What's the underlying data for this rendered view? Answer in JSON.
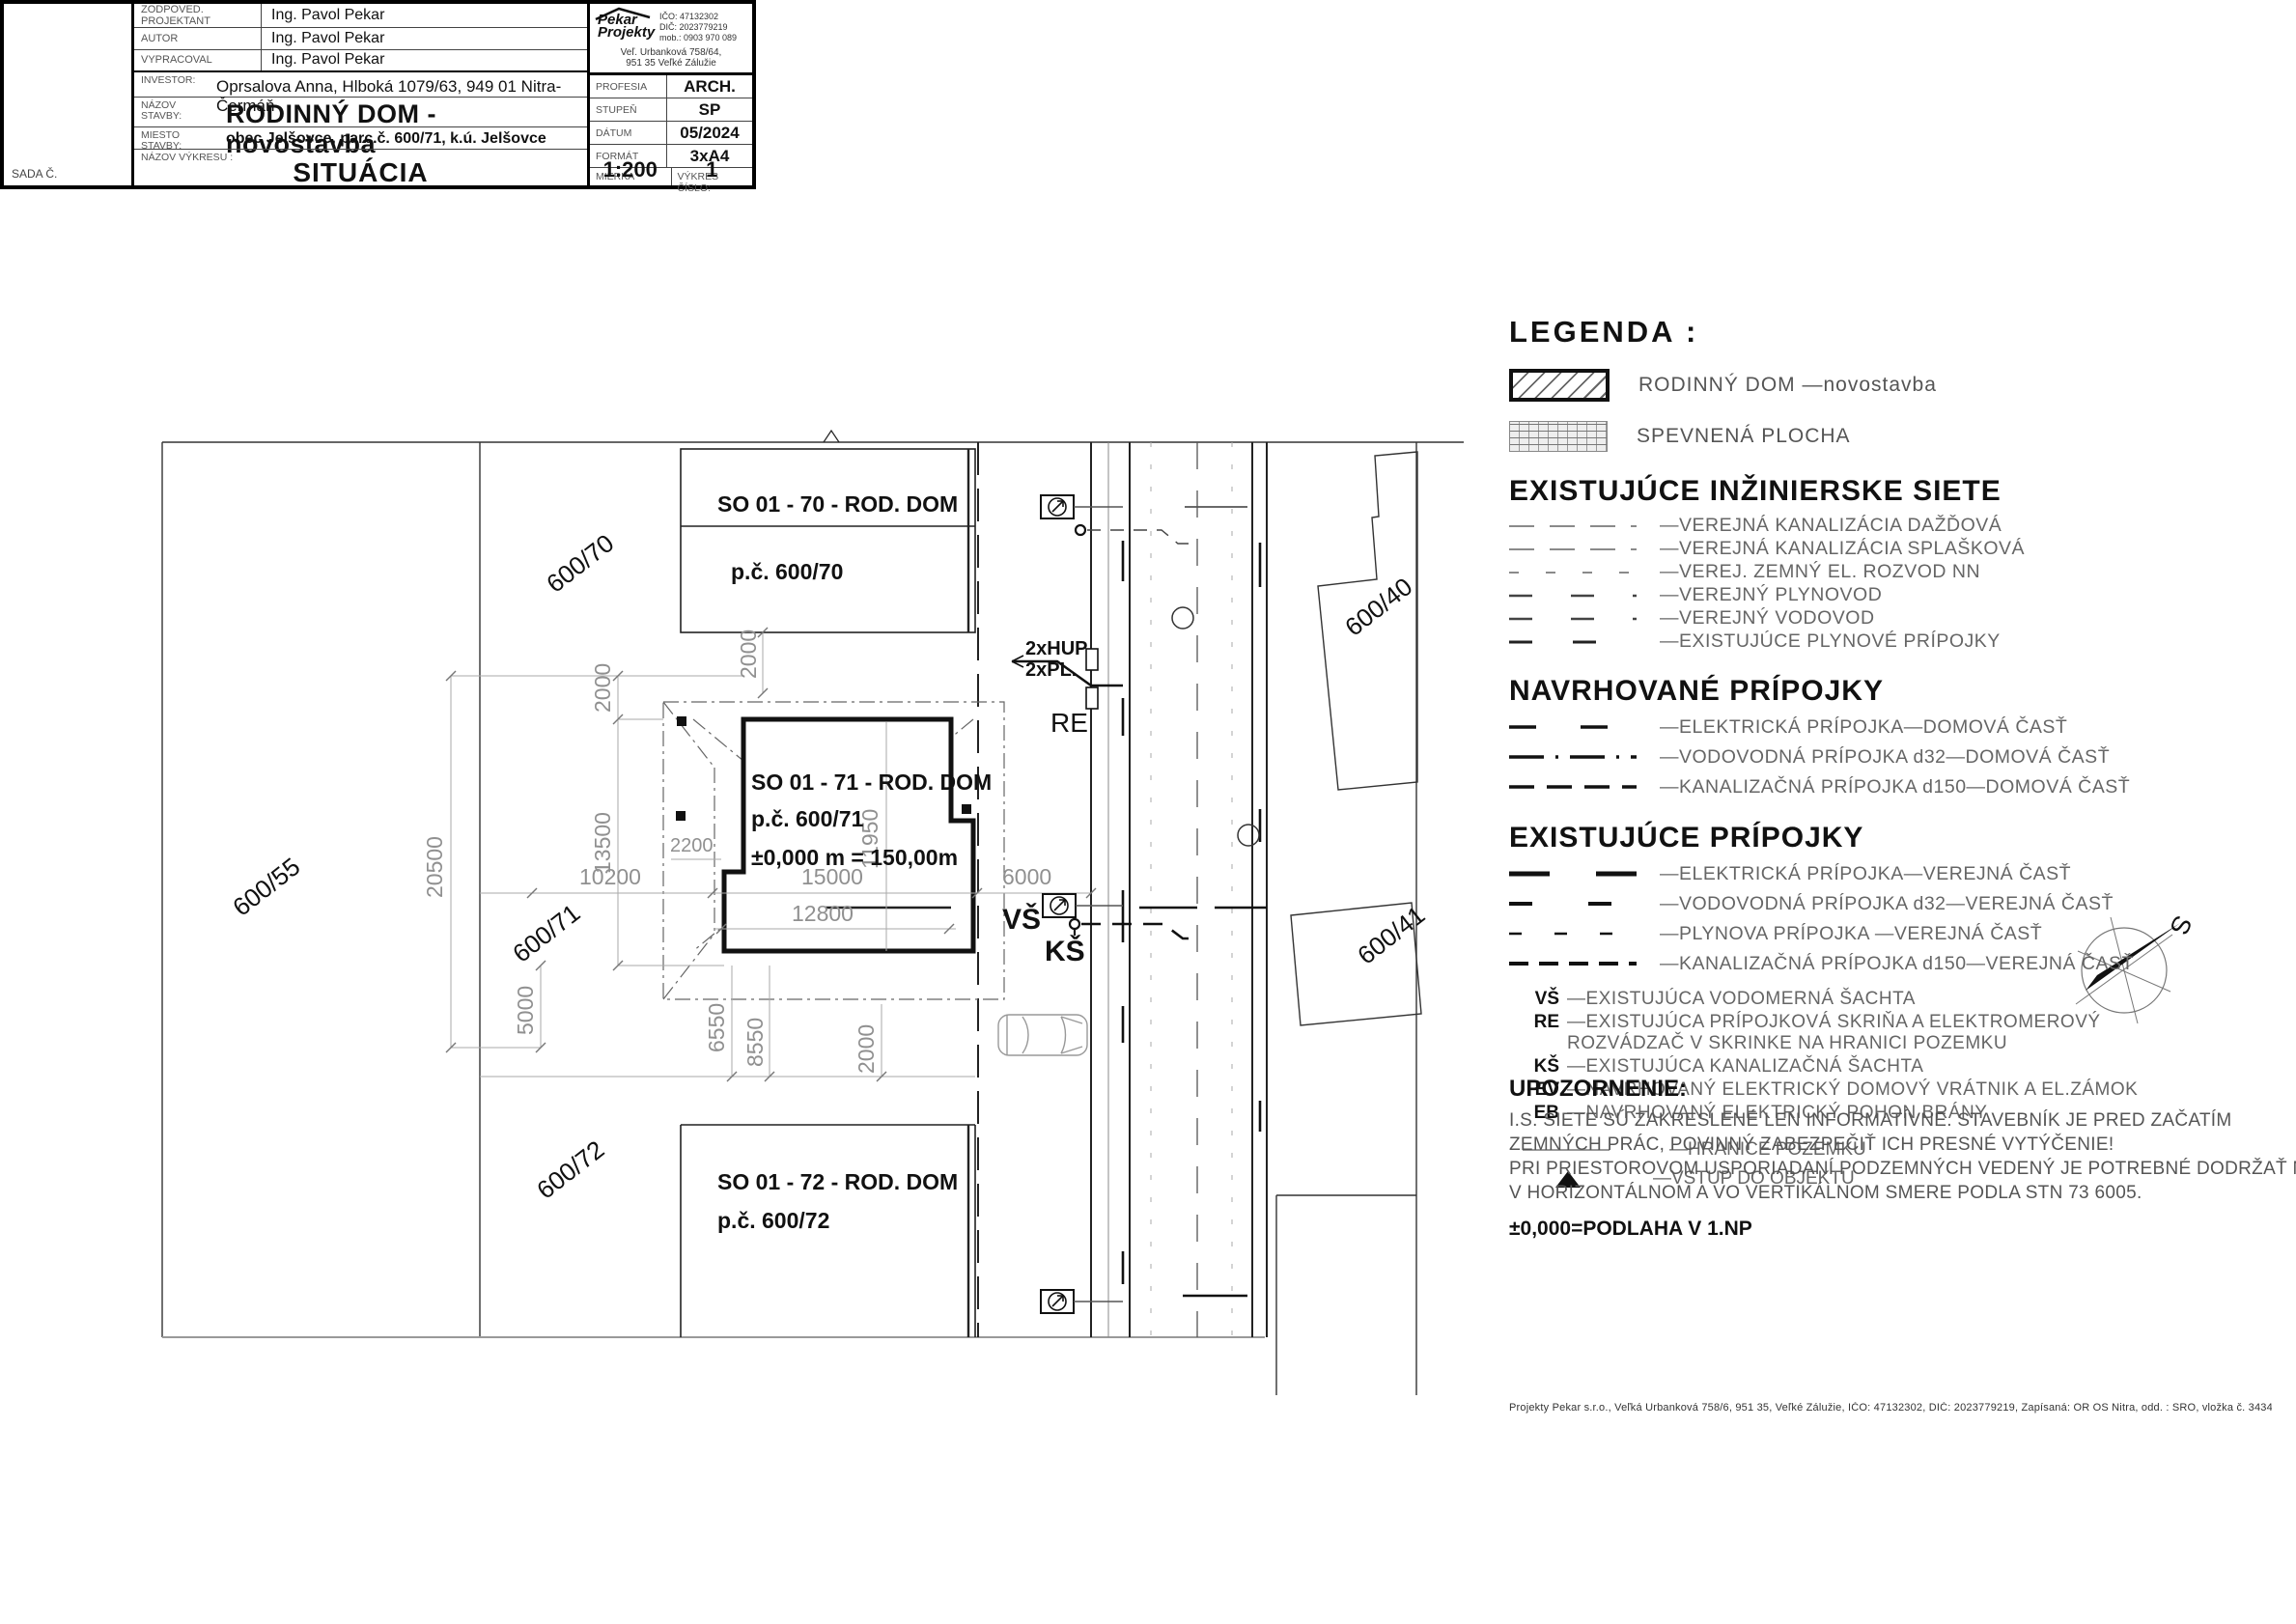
{
  "legend": {
    "title": "LEGENDA :",
    "swatches": [
      {
        "label": "RODINNÝ DOM  —novostavba"
      },
      {
        "label": "SPEVNENÁ PLOCHA"
      }
    ],
    "sections": [
      {
        "heading": "EXISTUJÚCE INŽINIERSKE SIETE",
        "items": [
          "—VEREJNÁ KANALIZÁCIA DAŽĎOVÁ",
          "—VEREJNÁ KANALIZÁCIA SPLAŠKOVÁ",
          "—VEREJ. ZEMNÝ EL. ROZVOD NN",
          "—VEREJNÝ PLYNOVOD",
          "—VEREJNÝ VODOVOD",
          "—EXISTUJÚCE PLYNOVÉ PRÍPOJKY"
        ]
      },
      {
        "heading": "NAVRHOVANÉ PRÍPOJKY",
        "items": [
          "—ELEKTRICKÁ PRÍPOJKA—DOMOVÁ ČASŤ",
          "—VODOVODNÁ PRÍPOJKA d32—DOMOVÁ ČASŤ",
          "—KANALIZAČNÁ PRÍPOJKA d150—DOMOVÁ ČASŤ"
        ]
      },
      {
        "heading": "EXISTUJÚCE PRÍPOJKY",
        "items": [
          "—ELEKTRICKÁ PRÍPOJKA—VEREJNÁ ČASŤ",
          "—VODOVODNÁ PRÍPOJKA d32—VEREJNÁ ČASŤ",
          "—PLYNOVA PRÍPOJKA —VEREJNÁ ČASŤ",
          "—KANALIZAČNÁ PRÍPOJKA d150—VEREJNÁ ČASŤ"
        ]
      }
    ],
    "abbreviations": [
      {
        "abbr": "VŠ",
        "text": "—EXISTUJÚCA VODOMERNÁ ŠACHTA"
      },
      {
        "abbr": "RE",
        "text": "—EXISTUJÚCA PRÍPOJKOVÁ SKRIŇA A ELEKTROMEROVÝ",
        "text2": "ROZVÁDZAČ V SKRINKE NA HRANICI POZEMKU"
      },
      {
        "abbr": "KŠ",
        "text": "—EXISTUJÚCA KANALIZAČNÁ ŠACHTA"
      },
      {
        "abbr": "EV",
        "text": "—NAVRHOVANÝ ELEKTRICKÝ DOMOVÝ VRÁTNIK A EL.ZÁMOK"
      },
      {
        "abbr": "EB",
        "text": "—NAVRHOVANÝ ELEKTRICKÝ POHON BRÁNY"
      }
    ],
    "boundary_label": "—HRANICE POZEMKU",
    "entrance_label": "—VSTUP DO OBJEKTU"
  },
  "notice": {
    "title": "UPOZORNENIE:",
    "lines": [
      "I.S. SIETE SÚ ZAKRESLENÉ LEN INFORMATÍVNE. STAVEBNÍK JE PRED ZAČATÍM",
      "ZEMNÝCH PRÁC, POVINNÝ ZABEZPEČIŤ ICH PRESNÉ VYTÝČENIE!",
      "PRI PRIESTOROVOM USPORIADANÍ PODZEMNÝCH VEDENÝ JE POTREBNÉ DODRŽAŤ MIN. VZDIALENOSTI",
      "V HORIZONTÁLNOM A VO VERTIKÁLNOM SMERE PODLA STN 73 6005."
    ],
    "level_note": "±0,000=PODLAHA V 1.NP"
  },
  "titleblock": {
    "rows": [
      {
        "label": "ZODPOVED. PROJEKTANT",
        "value": "Ing. Pavol Pekar"
      },
      {
        "label": "AUTOR",
        "value": "Ing. Pavol Pekar"
      },
      {
        "label": "VYPRACOVAL",
        "value": "Ing. Pavol Pekar"
      }
    ],
    "investor_label": "INVESTOR:",
    "investor": "Oprsalova Anna, Hlboká 1079/63, 949 01 Nitra-Čermáň",
    "nazov_label1": "NÁZOV",
    "nazov_label2": "STAVBY:",
    "nazov_stavby": "RODINNÝ DOM - novostavba",
    "miesto_label1": "MIESTO",
    "miesto_label2": "STAVBY:",
    "miesto_stavby": "obec Jelšovce, parc.č. 600/71, k.ú. Jelšovce",
    "vykres_label": "NÁZOV VÝKRESU :",
    "nazov_vykresu": "SITUÁCIA",
    "sada_label": "SADA Č.",
    "meta": [
      {
        "label": "PROFESIA",
        "value": "ARCH."
      },
      {
        "label": "STUPEŇ",
        "value": "SP"
      },
      {
        "label": "DÁTUM",
        "value": "05/2024"
      },
      {
        "label": "FORMÁT",
        "value": "3xA4"
      }
    ],
    "mierka_label": "MIERKA",
    "mierka": "1:200",
    "cislo_label": "VÝKRES ČÍSLO:",
    "cislo": "1",
    "logo": {
      "name1": "Pekar",
      "name2": "Projekty",
      "ico": "IČO: 47132302",
      "dic": "DIČ: 2023779219",
      "mob": "mob.: 0903 970 089",
      "addr1": "Veľ. Urbanková 758/64,",
      "addr2": "951 35 Veľké Zálužie"
    },
    "footer": "Projekty Pekar s.r.o.,  Veľká Urbanková 758/6,  951 35,  Veľké Zálužie,  IČO: 47132302,  DIČ: 2023779219,  Zapísaná: OR OS Nitra, odd. : SRO, vložka č. 34342/N"
  },
  "plan": {
    "buildings": [
      {
        "line1": "SO 01  - 70 - ROD. DOM",
        "line2": "p.č. 600/70"
      },
      {
        "line1": "SO 01  - 71 - ROD. DOM",
        "line2": "p.č. 600/71",
        "line3": "±0,000 m = 150,00m"
      },
      {
        "line1": "SO 01  - 72 - ROD. DOM",
        "line2": "p.č. 600/72"
      }
    ],
    "parcels": [
      "600/70",
      "600/55",
      "600/71",
      "600/72",
      "600/40",
      "600/41"
    ],
    "dims": {
      "d2000_left": "2000",
      "d2000_top": "2000",
      "d13500": "13500",
      "d20500": "20500",
      "d10200": "10200",
      "d2200": "2200",
      "d15000": "15000",
      "d12800": "12800",
      "d11950": "11950",
      "d6000": "6000",
      "d5000": "5000",
      "d6550": "6550",
      "d8550": "8550",
      "d2000_bot": "2000"
    },
    "labels": {
      "hup": "2xHUP",
      "pl": "2xPL.",
      "re": "RE",
      "vs": "VŠ",
      "ks": "KŠ",
      "north": "S"
    }
  }
}
